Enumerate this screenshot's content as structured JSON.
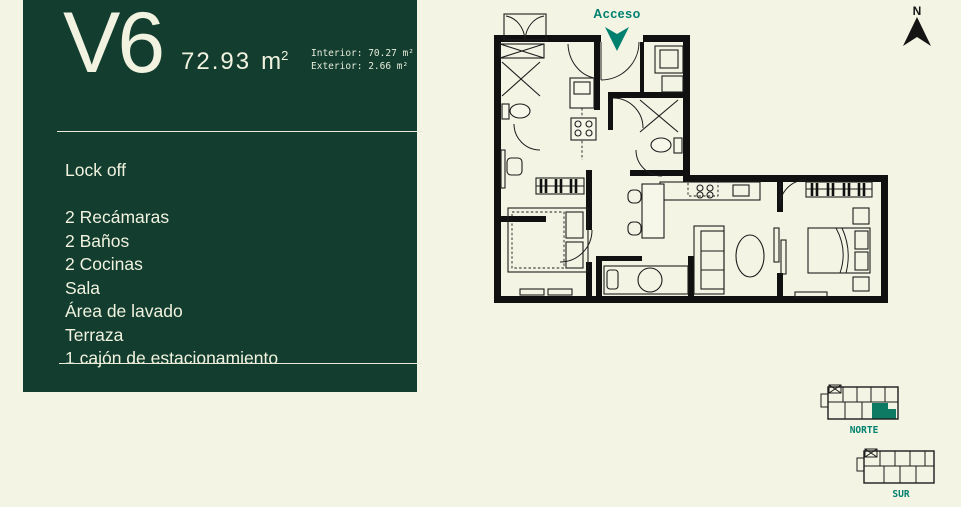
{
  "panel": {
    "unit_name": "V6",
    "total_area_value": "72.93",
    "total_area_unit": "m",
    "total_area_sup": "2",
    "interior_detail": "Interior: 70.27 m²",
    "exterior_detail": "Exterior: 2.66 m²",
    "features_heading": "Lock off",
    "features": [
      "2 Recámaras",
      "2 Baños",
      "2 Cocinas",
      "Sala",
      "Área de lavado",
      "Terraza",
      "1 cajón de estacionamiento"
    ]
  },
  "floorplan": {
    "access_label": "Acceso"
  },
  "compass": {
    "north_label": "N"
  },
  "locator": {
    "north_label": "NORTE",
    "south_label": "SUR"
  },
  "colors": {
    "background": "#f3f4e4",
    "panel_green": "#123d2f",
    "panel_text": "#f1f2df",
    "accent_teal": "#00806f",
    "locator_highlight": "#0e7a64",
    "plan_walls": "#101010"
  }
}
